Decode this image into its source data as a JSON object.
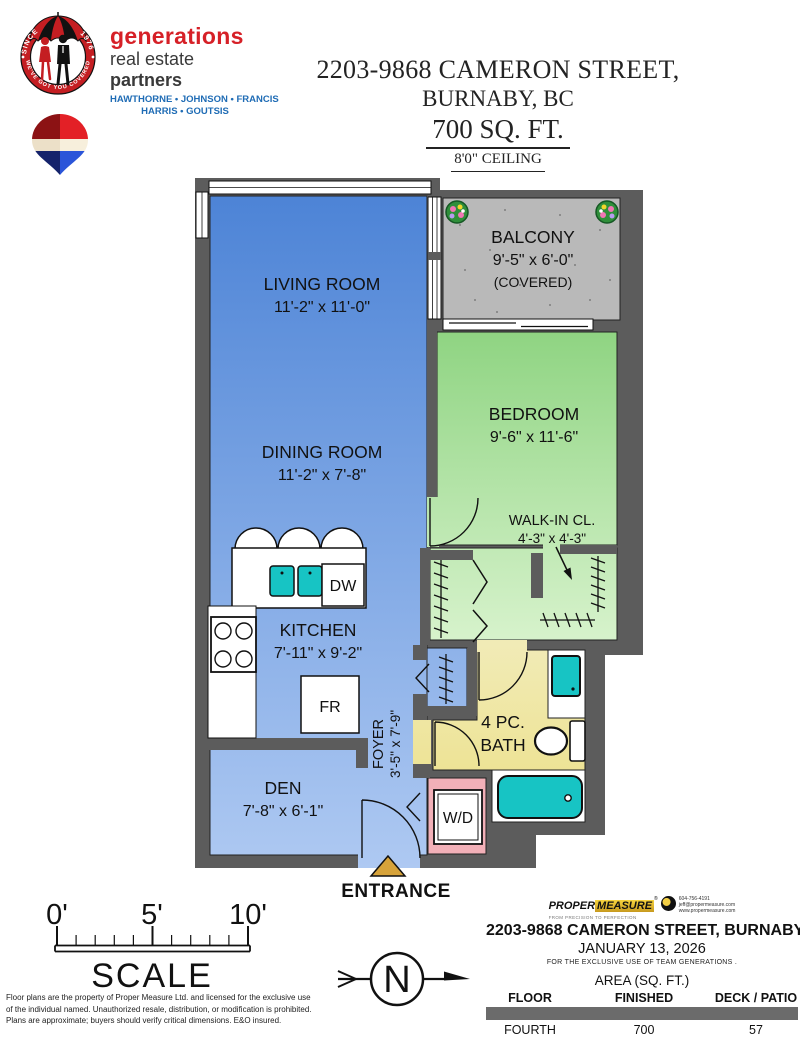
{
  "brand": {
    "badge": {
      "since": "SINCE",
      "year": "1976",
      "tagline": "WE'VE GOT YOU COVERED"
    },
    "name": "generations",
    "tagline_regular": "real estate ",
    "tagline_bold": "partners",
    "agents_line1": "HAWTHORNE • JOHNSON • FRANCIS",
    "agents_line2": "HARRIS • GOUTSIS"
  },
  "title": {
    "address": "2203-9868 CAMERON STREET,",
    "city": "BURNABY, BC",
    "area": "700 SQ. FT.",
    "ceiling": "8'0\" CEILING"
  },
  "plan": {
    "living": {
      "name": "LIVING ROOM",
      "dims": "11'-2\" x 11'-0\""
    },
    "dining": {
      "name": "DINING ROOM",
      "dims": "11'-2\" x 7'-8\""
    },
    "balcony": {
      "name": "BALCONY",
      "dims": "9'-5\" x 6'-0\"",
      "note": "(COVERED)"
    },
    "bedroom": {
      "name": "BEDROOM",
      "dims": "9'-6\" x 11'-6\""
    },
    "walkin": {
      "name": "WALK-IN CL.",
      "dims": "4'-3\" x 4'-3\""
    },
    "kitchen": {
      "name": "KITCHEN",
      "dims": "7'-11\" x 9'-2\""
    },
    "foyer": {
      "name": "FOYER",
      "dims": "3'-5\" x 7'-9\""
    },
    "bath": {
      "line1": "4 PC.",
      "line2": "BATH"
    },
    "den": {
      "name": "DEN",
      "dims": "7'-8\" x 6'-1\""
    },
    "appliances": {
      "dishwasher": "DW",
      "fridge": "FR",
      "washer_dryer": "W/D"
    },
    "entrance": "ENTRANCE"
  },
  "scale_bar": {
    "tick_0": "0'",
    "tick_5": "5'",
    "tick_10": "10'",
    "label": "SCALE"
  },
  "compass": {
    "north": "N"
  },
  "disclaimer": {
    "line1": "Floor plans are the property of Proper Measure Ltd. and licensed for the exclusive use",
    "line2": "of the individual named. Unauthorized resale, distribution, or modification is prohibited.",
    "line3": "Plans are approximate; buyers should verify critical dimensions. E&O insured."
  },
  "footer": {
    "logo": {
      "word_1": "PROPER",
      "word_2": "MEASURE",
      "reg": "®",
      "tagline": "FROM PRECISION TO PERFECTION",
      "phone": "604-756-4191",
      "email": "jeff@propermeasure.com",
      "website": "www.propermeasure.com"
    },
    "address": "2203-9868 CAMERON STREET, BURNABY",
    "date": "JANUARY 13, 2026",
    "exclusive": "FOR THE EXCLUSIVE USE OF TEAM GENERATIONS .",
    "table": {
      "area_header": "AREA (SQ. FT.)",
      "columns": [
        "FLOOR",
        "FINISHED",
        "DECK / PATIO"
      ],
      "rows": [
        [
          "FOURTH",
          "700",
          "57"
        ]
      ]
    }
  },
  "colors": {
    "floor_blue": "#5b8dd9",
    "floor_green": "#9ad98c",
    "balcony_gray": "#b9b9b9",
    "bath_yellow": "#f0e8a4",
    "laundry_pink": "#f2b0b8",
    "fixture_teal": "#17c4c4",
    "wall_gray": "#5c5c5c",
    "entrance_gold": "#d7a33a",
    "brand_red": "#c41e22",
    "brand_blue": "#1f6cb5"
  }
}
